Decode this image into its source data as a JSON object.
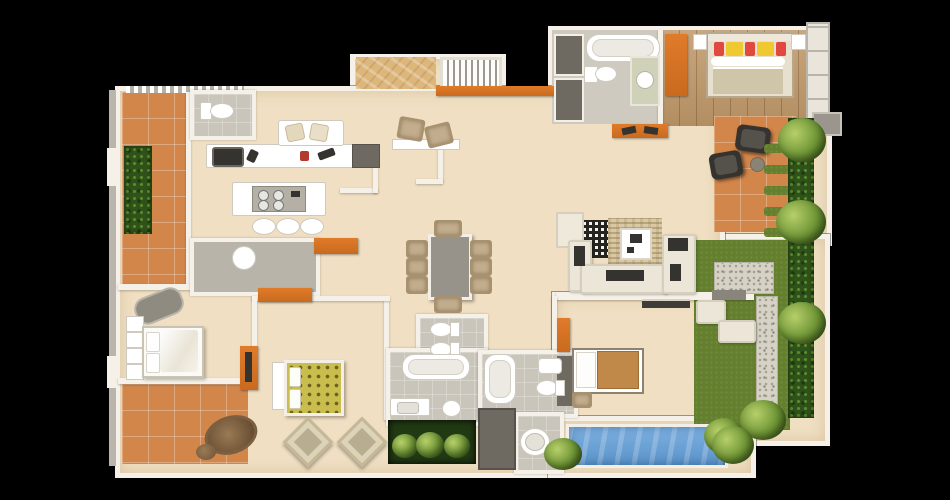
{
  "scene": {
    "description": "3D rendered apartment floor plan, top-down view, no text labels",
    "background": "#000000"
  },
  "palette": {
    "black": "#000000",
    "wall": "#f5f1e8",
    "floor": "#f0dfc2",
    "floor_light": "#f4e9d2",
    "wood": "#a8835a",
    "wood_light": "#c29a6b",
    "plywood": "#ddb67c",
    "terracotta": "#d2864a",
    "orange": "#e07b2a",
    "gray_floor": "#b9b4a9",
    "gray_tile": "#c9c5bb",
    "dark_gray": "#6e6961",
    "charcoal": "#35332f",
    "cream": "#efe9dc",
    "sofa": "#ece6d8",
    "rug": "#d9c8a2",
    "hedge": "#2f521a",
    "lawn": "#647f2e",
    "pebble": "#d6d2c6",
    "pool": "#6aa2d8",
    "duvet_yellow": "#c9bd4e",
    "pillow_yellow": "#f0c830",
    "pillow_red": "#e04840",
    "blanket_tan": "#c08849",
    "chair_tan": "#c2ad8d",
    "vanity_green": "#cfd2b8",
    "mattress": "#cfc5a8"
  }
}
